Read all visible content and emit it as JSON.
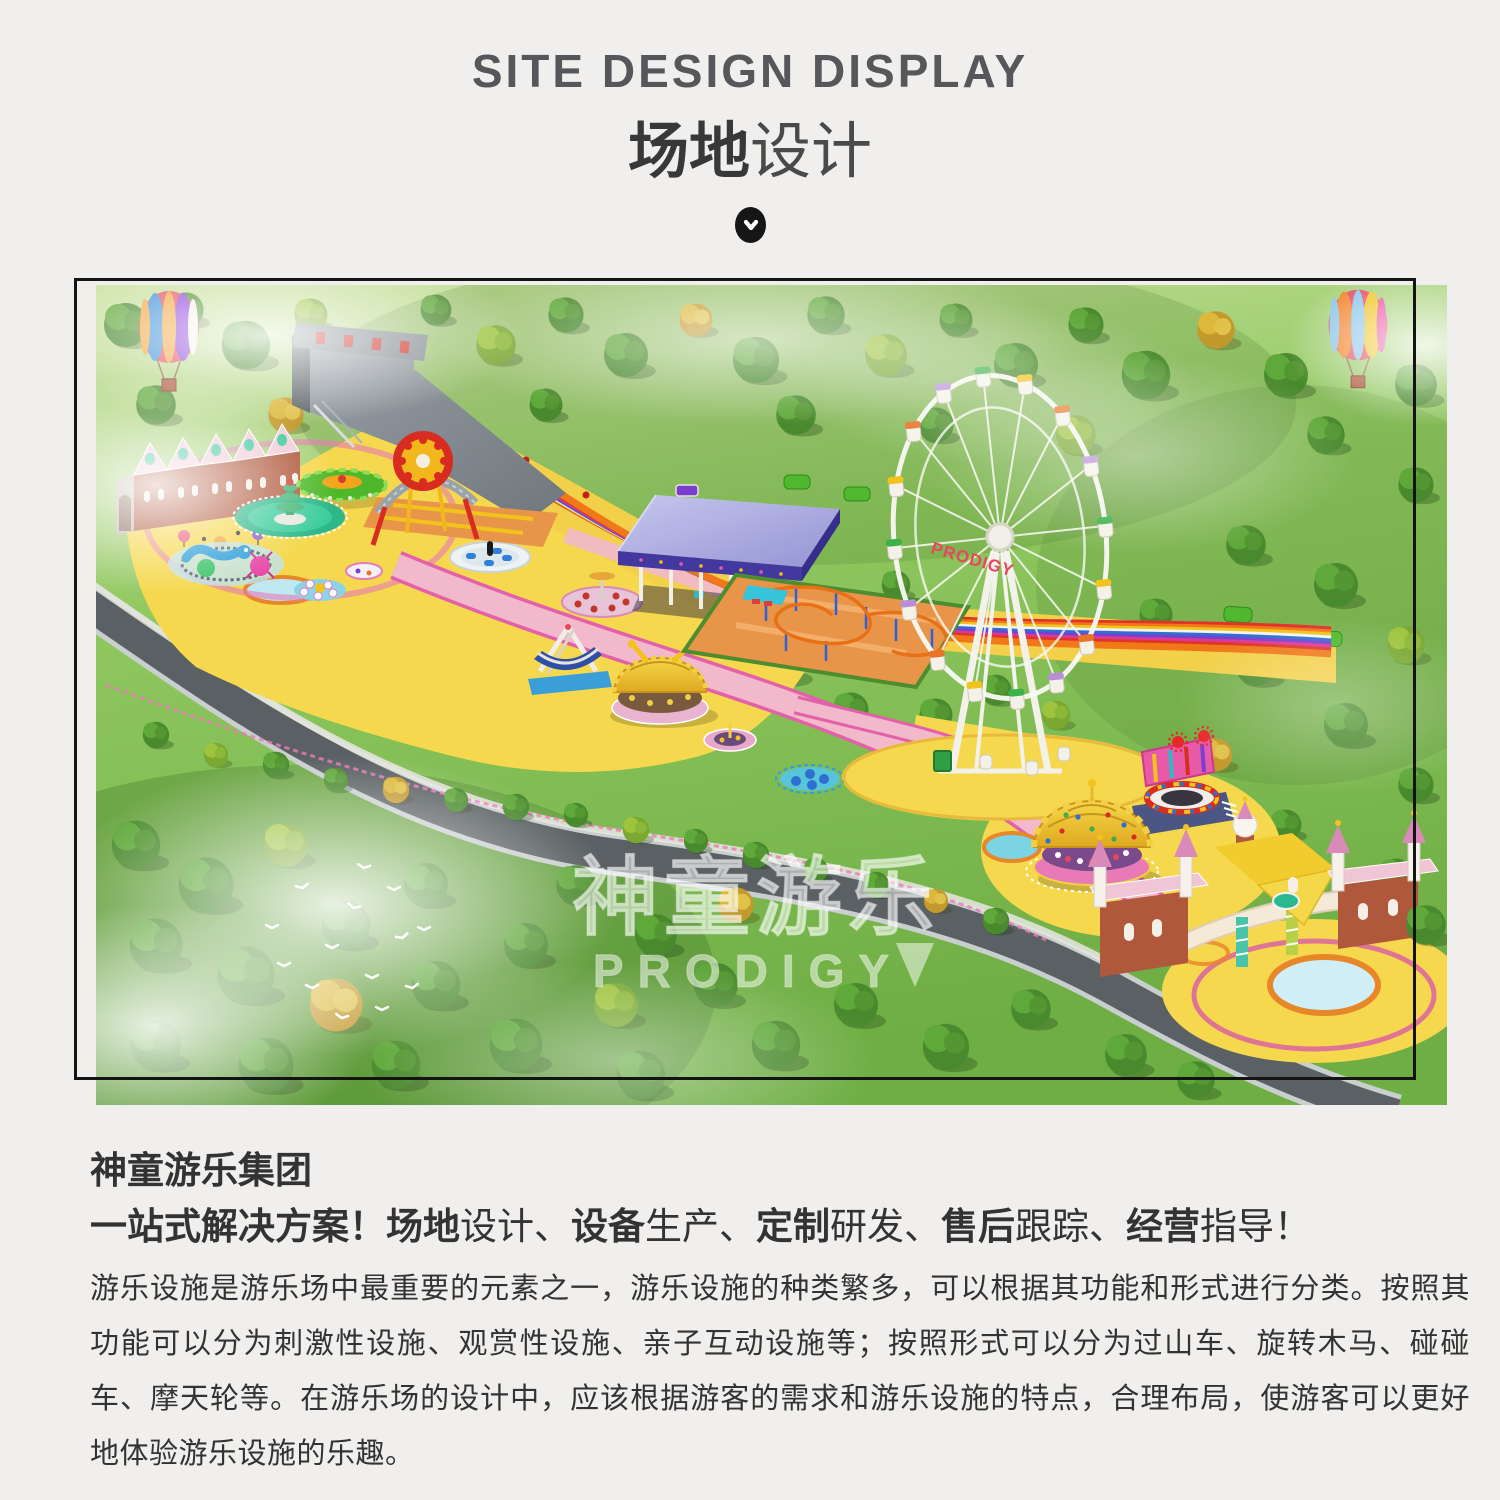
{
  "header": {
    "title_en": "SITE DESIGN DISPLAY",
    "title_zh_bold": "场地",
    "title_zh_light": "设计"
  },
  "scene": {
    "watermark_line1": "神童游乐",
    "watermark_line2": "PRODIGY",
    "ferris_label": "PRODIGY"
  },
  "intro": {
    "heading": "神童游乐集团",
    "subtitle_parts": [
      {
        "t": "一站式解决方案！",
        "b": true
      },
      {
        "t": "场地",
        "b": true
      },
      {
        "t": "设计、",
        "b": false
      },
      {
        "t": "设备",
        "b": true
      },
      {
        "t": "生产、",
        "b": false
      },
      {
        "t": "定制",
        "b": true
      },
      {
        "t": "研发、",
        "b": false
      },
      {
        "t": "售后",
        "b": true
      },
      {
        "t": "跟踪、",
        "b": false
      },
      {
        "t": "经营",
        "b": true
      },
      {
        "t": "指导！",
        "b": false
      }
    ],
    "paragraph": "游乐设施是游乐场中最重要的元素之一，游乐设施的种类繁多，可以根据其功能和形式进行分类。按照其功能可以分为刺激性设施、观赏性设施、亲子互动设施等；按照形式可以分为过山车、旋转木马、碰碰车、摩天轮等。在游乐场的设计中，应该根据游客的需求和游乐设施的特点，合理布局，使游客可以更好地体验游乐设施的乐趣。"
  },
  "colors": {
    "page_background": "#f0efed",
    "title_gray": "#55575a",
    "body_text": "#333333",
    "frame_border": "#141414",
    "park_yellow": "#f6d84e",
    "path_pink": "#f2b8cc",
    "accent_magenta": "#e261a8",
    "grass_green": "#7fba4e",
    "watermark_white": "#ffffff"
  }
}
